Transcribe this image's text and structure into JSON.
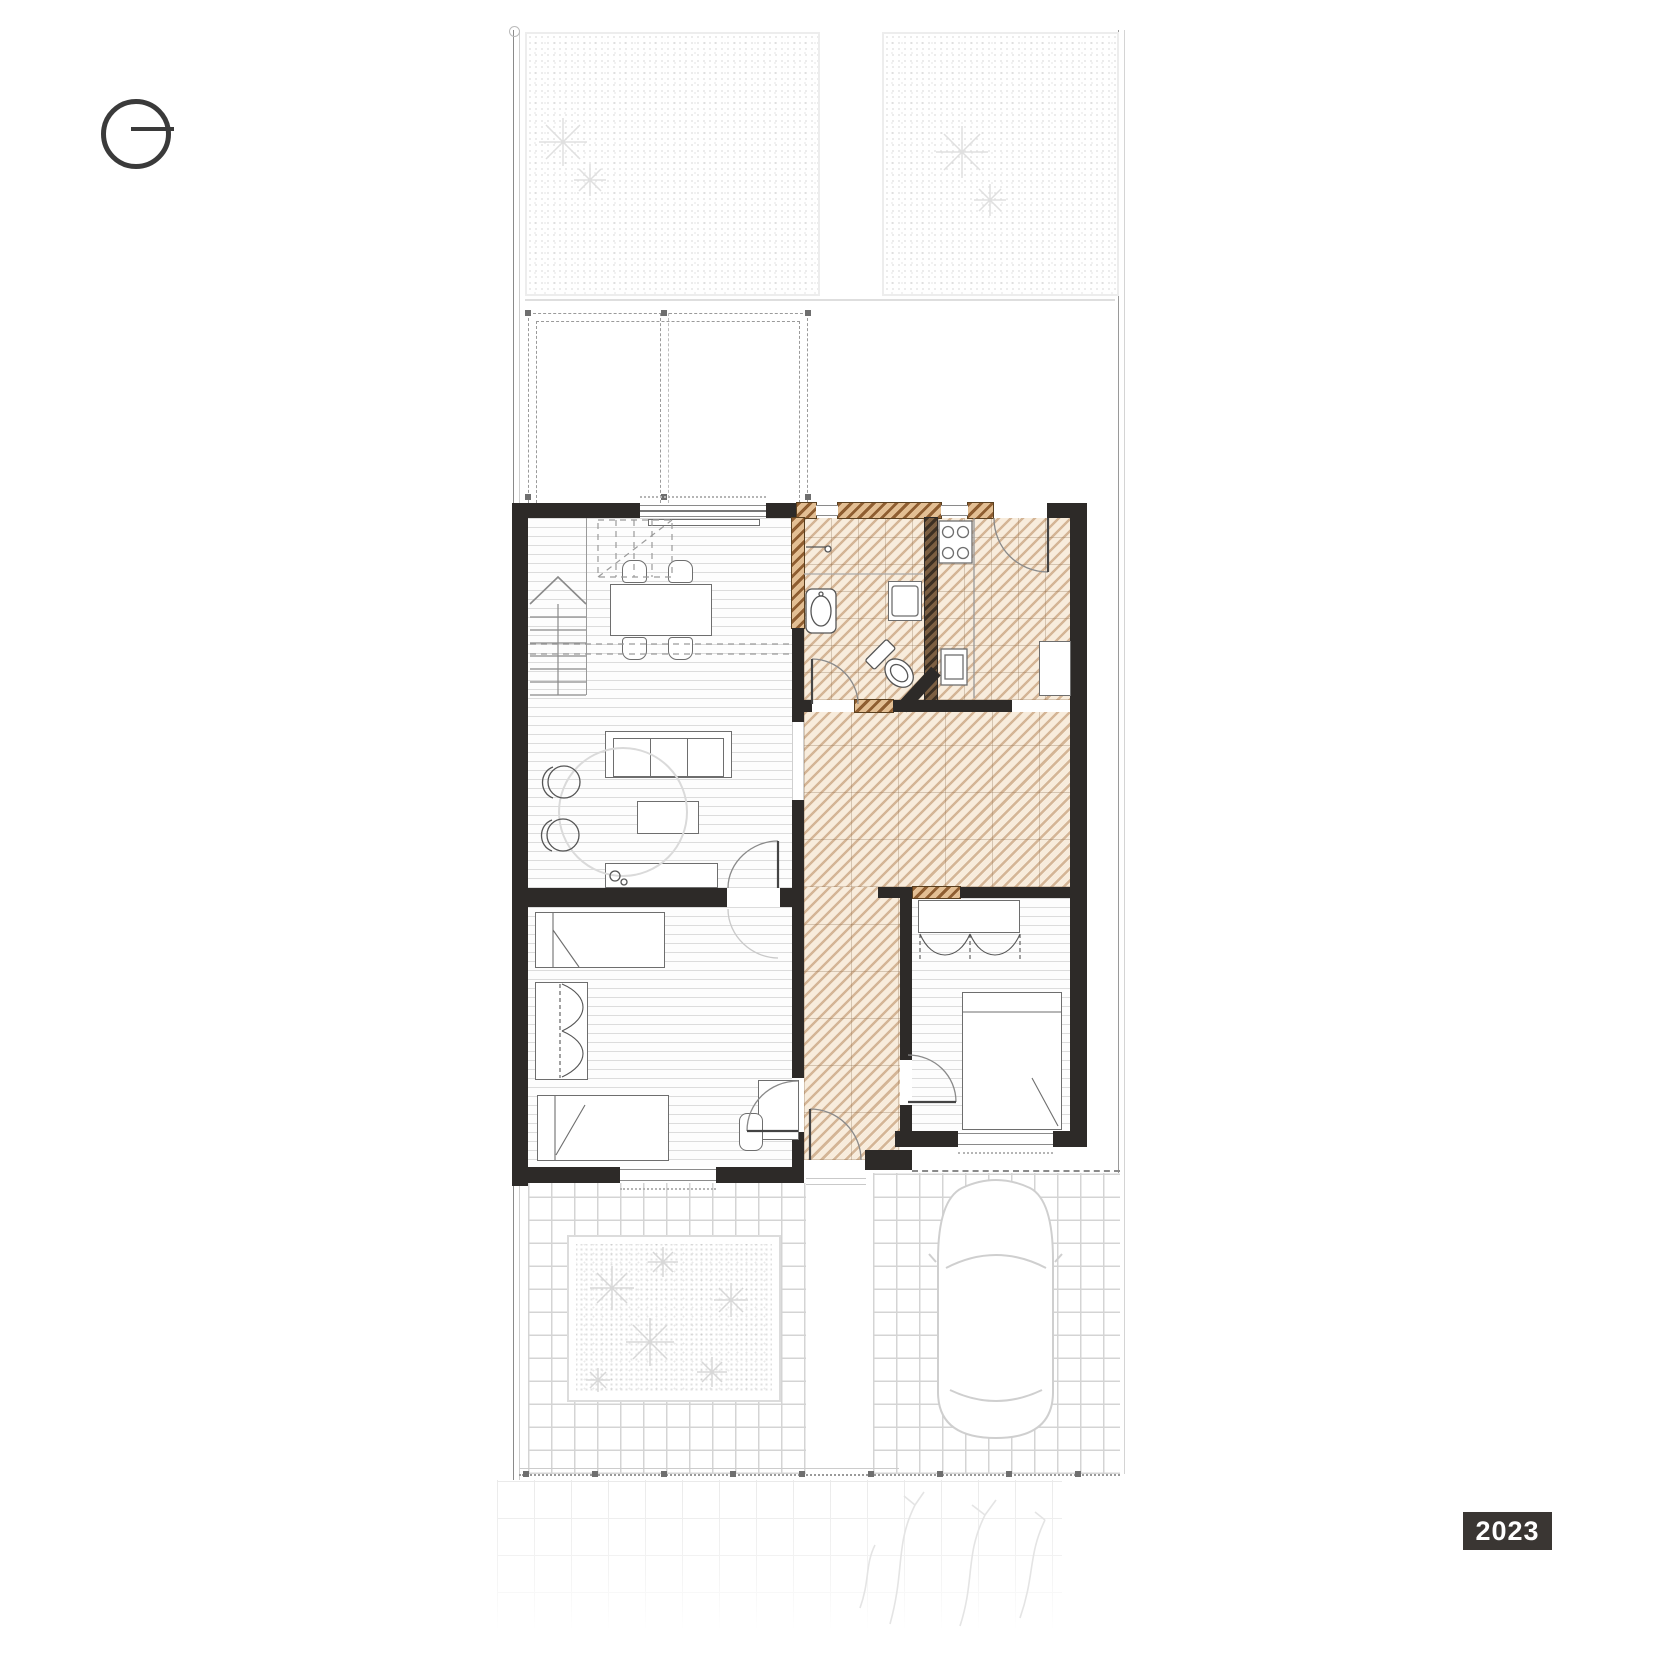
{
  "page": {
    "type_label": "ground-floor-plan",
    "year_badge": "2023"
  },
  "colors": {
    "wall_black": "#2d2a28",
    "new_construction_hatch_dark": "#8f5e31",
    "new_construction_hatch_light": "#e3bf94",
    "renovated_floor_tint": "#f7eddf",
    "drawing_light_gray": "#d4d4d4",
    "badge_background": "#3a3633",
    "badge_text": "#ffffff"
  },
  "symbols": {
    "north_indicator": "circle-with-east-needle",
    "fence": "dotted-line-with-posts",
    "pergola": "double-dashed-outline"
  }
}
